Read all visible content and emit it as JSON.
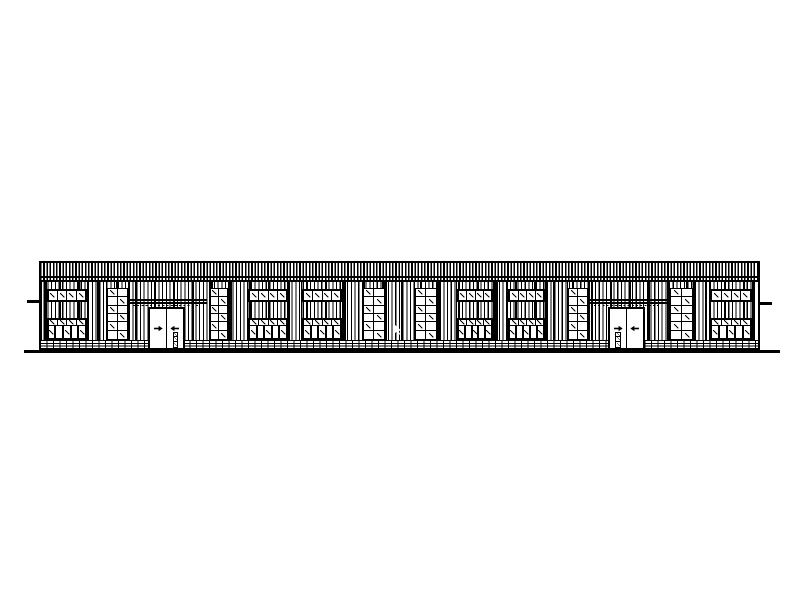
{
  "colors": {
    "ink": "#000000",
    "paper": "#ffffff"
  },
  "drawing": {
    "description": "single-storey industrial building front elevation, corrugated cladding, brick plinth",
    "canvas": {
      "width": 791,
      "height": 593
    },
    "building": {
      "left": 40,
      "top": 261,
      "width": 719,
      "fascia_divider_y": 276,
      "wall_top": 282,
      "plinth_top": 340,
      "ground_y": 350
    },
    "ground_line": {
      "left": 24,
      "top": 350,
      "width": 756,
      "height": 3
    },
    "side_ticks": [
      {
        "left": 27,
        "top": 300,
        "width": 14,
        "height": 3
      },
      {
        "left": 758,
        "top": 302,
        "width": 14,
        "height": 3
      }
    ],
    "window_modules": [
      {
        "left": 46.5,
        "width": 40.5
      },
      {
        "left": 248,
        "width": 40
      },
      {
        "left": 302,
        "width": 40
      },
      {
        "left": 457,
        "width": 36
      },
      {
        "left": 508,
        "width": 37
      },
      {
        "left": 710,
        "width": 42
      }
    ],
    "upper_band": {
      "top": 289,
      "height": 13,
      "panes": 4
    },
    "lower_band": {
      "top": 318,
      "height": 22,
      "transom_height": 6,
      "panes": 5
    },
    "stacked_windows": [
      {
        "left": 107,
        "width": 21
      },
      {
        "left": 210,
        "width": 18
      },
      {
        "left": 363,
        "width": 22
      },
      {
        "left": 415,
        "width": 22
      },
      {
        "left": 568,
        "width": 20
      },
      {
        "left": 670,
        "width": 23
      }
    ],
    "stacked_spec": {
      "top": 288,
      "height": 52,
      "cols": 2,
      "rows": 6
    },
    "canopies": [
      {
        "left": 127,
        "width": 80
      },
      {
        "left": 588,
        "width": 79
      }
    ],
    "canopy_spec": {
      "top": 299,
      "line_gap": 3,
      "dash_drop": 5.5
    },
    "doors": [
      {
        "left": 148,
        "width": 36.5,
        "vision": "right"
      },
      {
        "left": 608,
        "width": 37,
        "vision": "left"
      }
    ],
    "door_spec": {
      "top": 307,
      "bottom": 350,
      "arrow_y": 327
    },
    "cursor": {
      "left": 394,
      "top": 321
    }
  }
}
